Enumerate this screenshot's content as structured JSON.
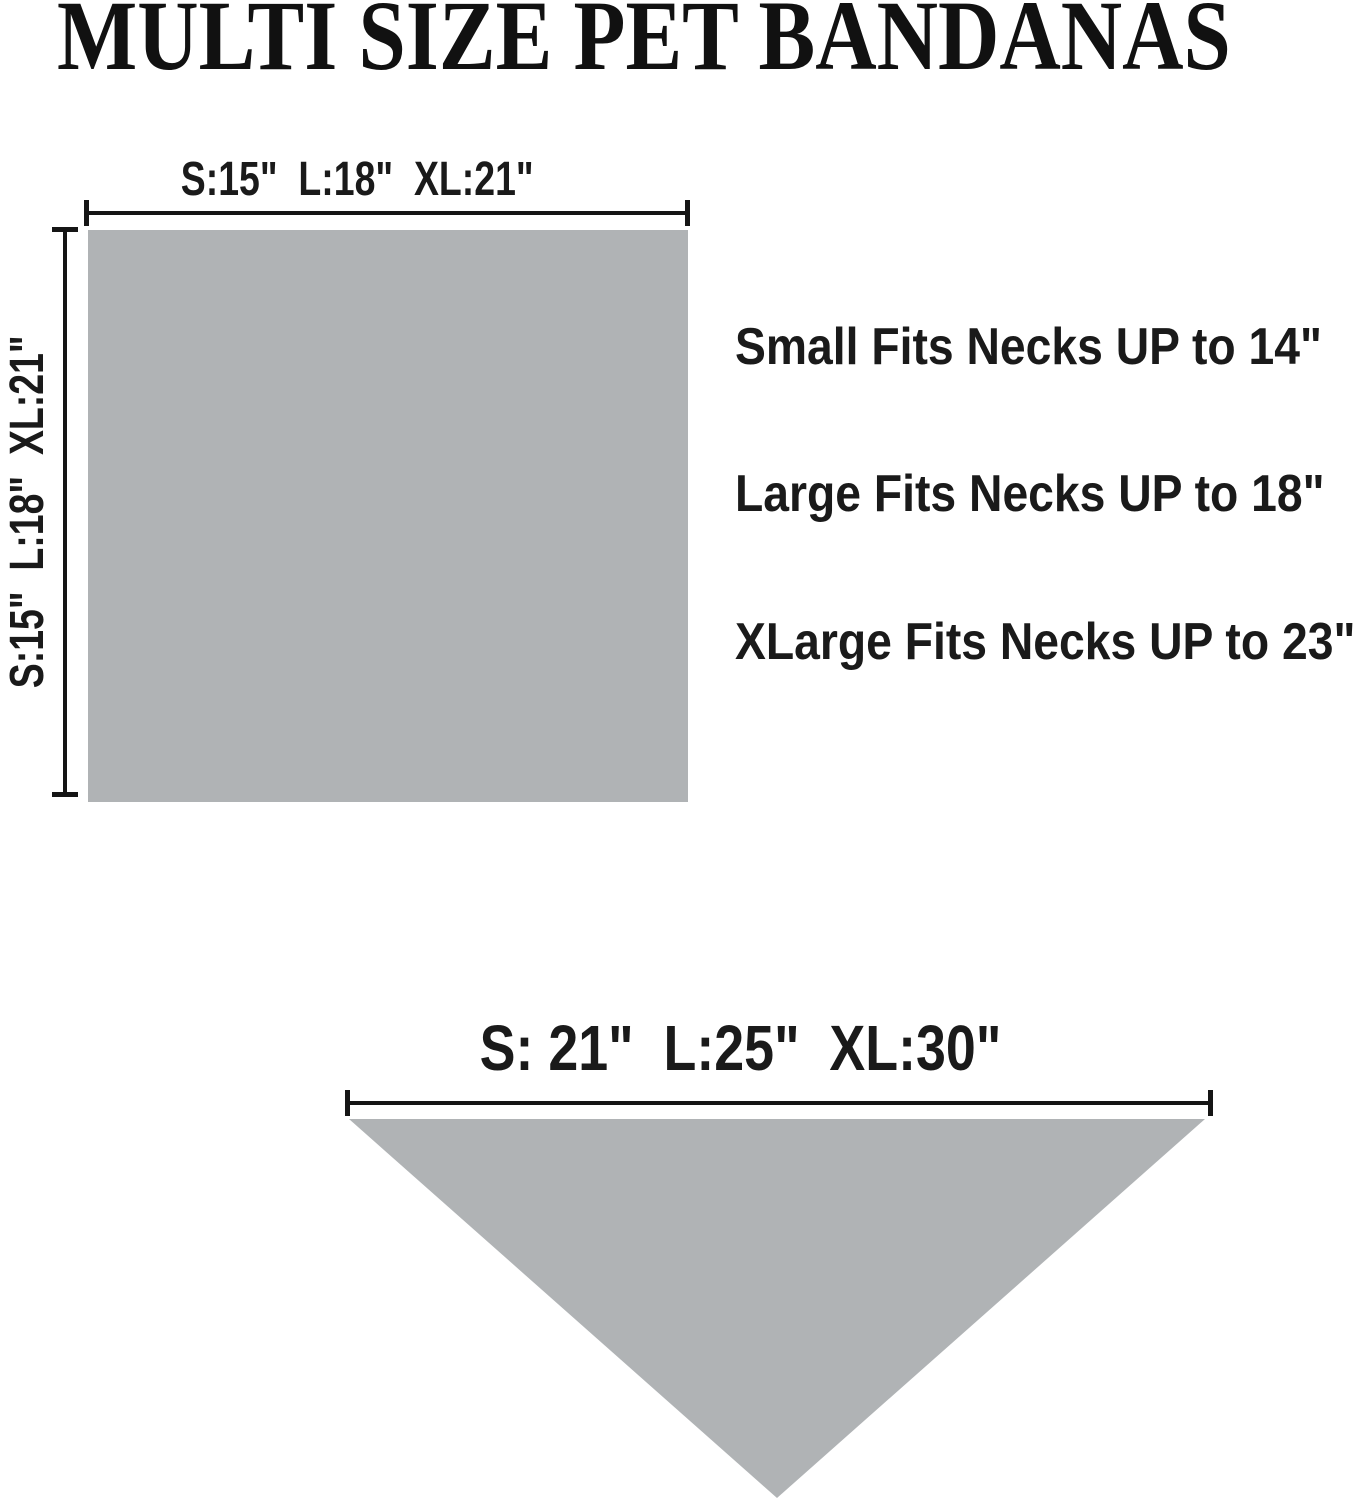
{
  "title": "MULTI SIZE PET BANDANAS",
  "flat_diagram": {
    "shape": "square",
    "width_label": "S:15\"  L:18\"  XL:21\"",
    "height_label": "S:15\"  L:18\"  XL:21\""
  },
  "fit_notes": [
    "Small Fits Necks UP to 14\"",
    "Large Fits Necks UP to 18\"",
    "XLarge Fits Necks UP to 23\""
  ],
  "folded_diagram": {
    "shape": "triangle",
    "width_label": "S: 21\"  L:25\"  XL:30\""
  },
  "colors": {
    "fabric_gray": "#b0b3b5",
    "line_black": "#151515",
    "background": "#ffffff"
  }
}
